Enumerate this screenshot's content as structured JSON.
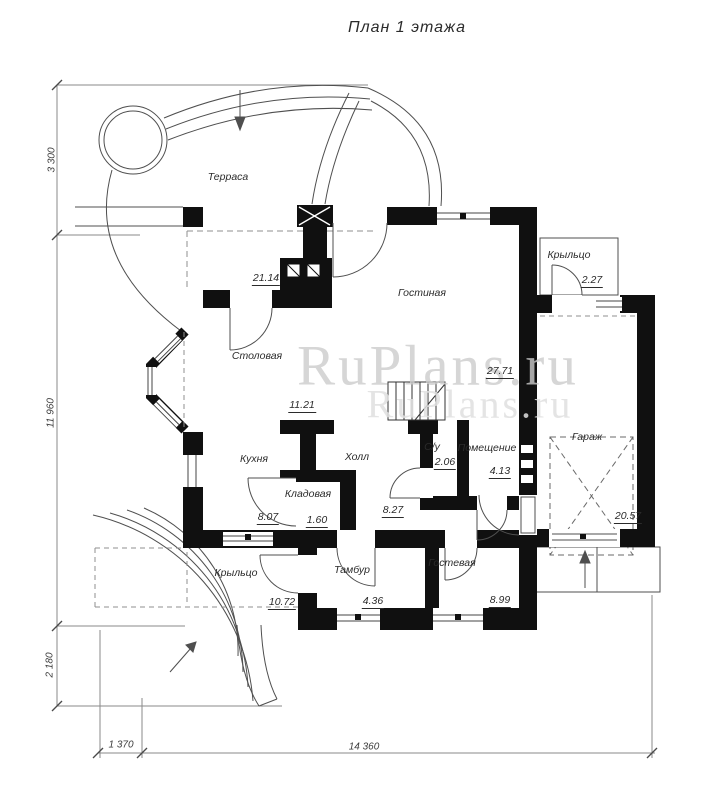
{
  "title": "План 1 этажа",
  "watermark": "RuPlans.ru",
  "rooms": [
    {
      "id": "terrace",
      "name": "Терраса",
      "area": "21.14"
    },
    {
      "id": "living",
      "name": "Гостиная",
      "area": "27.71"
    },
    {
      "id": "dining",
      "name": "Столовая",
      "area": "11.21"
    },
    {
      "id": "kitchen",
      "name": "Кухня",
      "area": "8.07"
    },
    {
      "id": "hall",
      "name": "Холл",
      "area": "8.27"
    },
    {
      "id": "wc",
      "name": "С/у",
      "area": "2.06"
    },
    {
      "id": "room",
      "name": "Помещение",
      "area": "4.13"
    },
    {
      "id": "pantry",
      "name": "Кладовая",
      "area": "1.60"
    },
    {
      "id": "garage",
      "name": "Гараж",
      "area": "20.57"
    },
    {
      "id": "tambour",
      "name": "Тамбур",
      "area": "4.36"
    },
    {
      "id": "guest",
      "name": "Гостевая",
      "area": "8.99"
    },
    {
      "id": "porch-left",
      "name": "Крыльцо",
      "area": "10.72"
    },
    {
      "id": "porch-right",
      "name": "Крыльцо",
      "area": "2.27"
    }
  ],
  "dimensions": {
    "left": [
      "3 300",
      "11 960",
      "2 180"
    ],
    "bottom": [
      "1 370",
      "14 360"
    ]
  }
}
